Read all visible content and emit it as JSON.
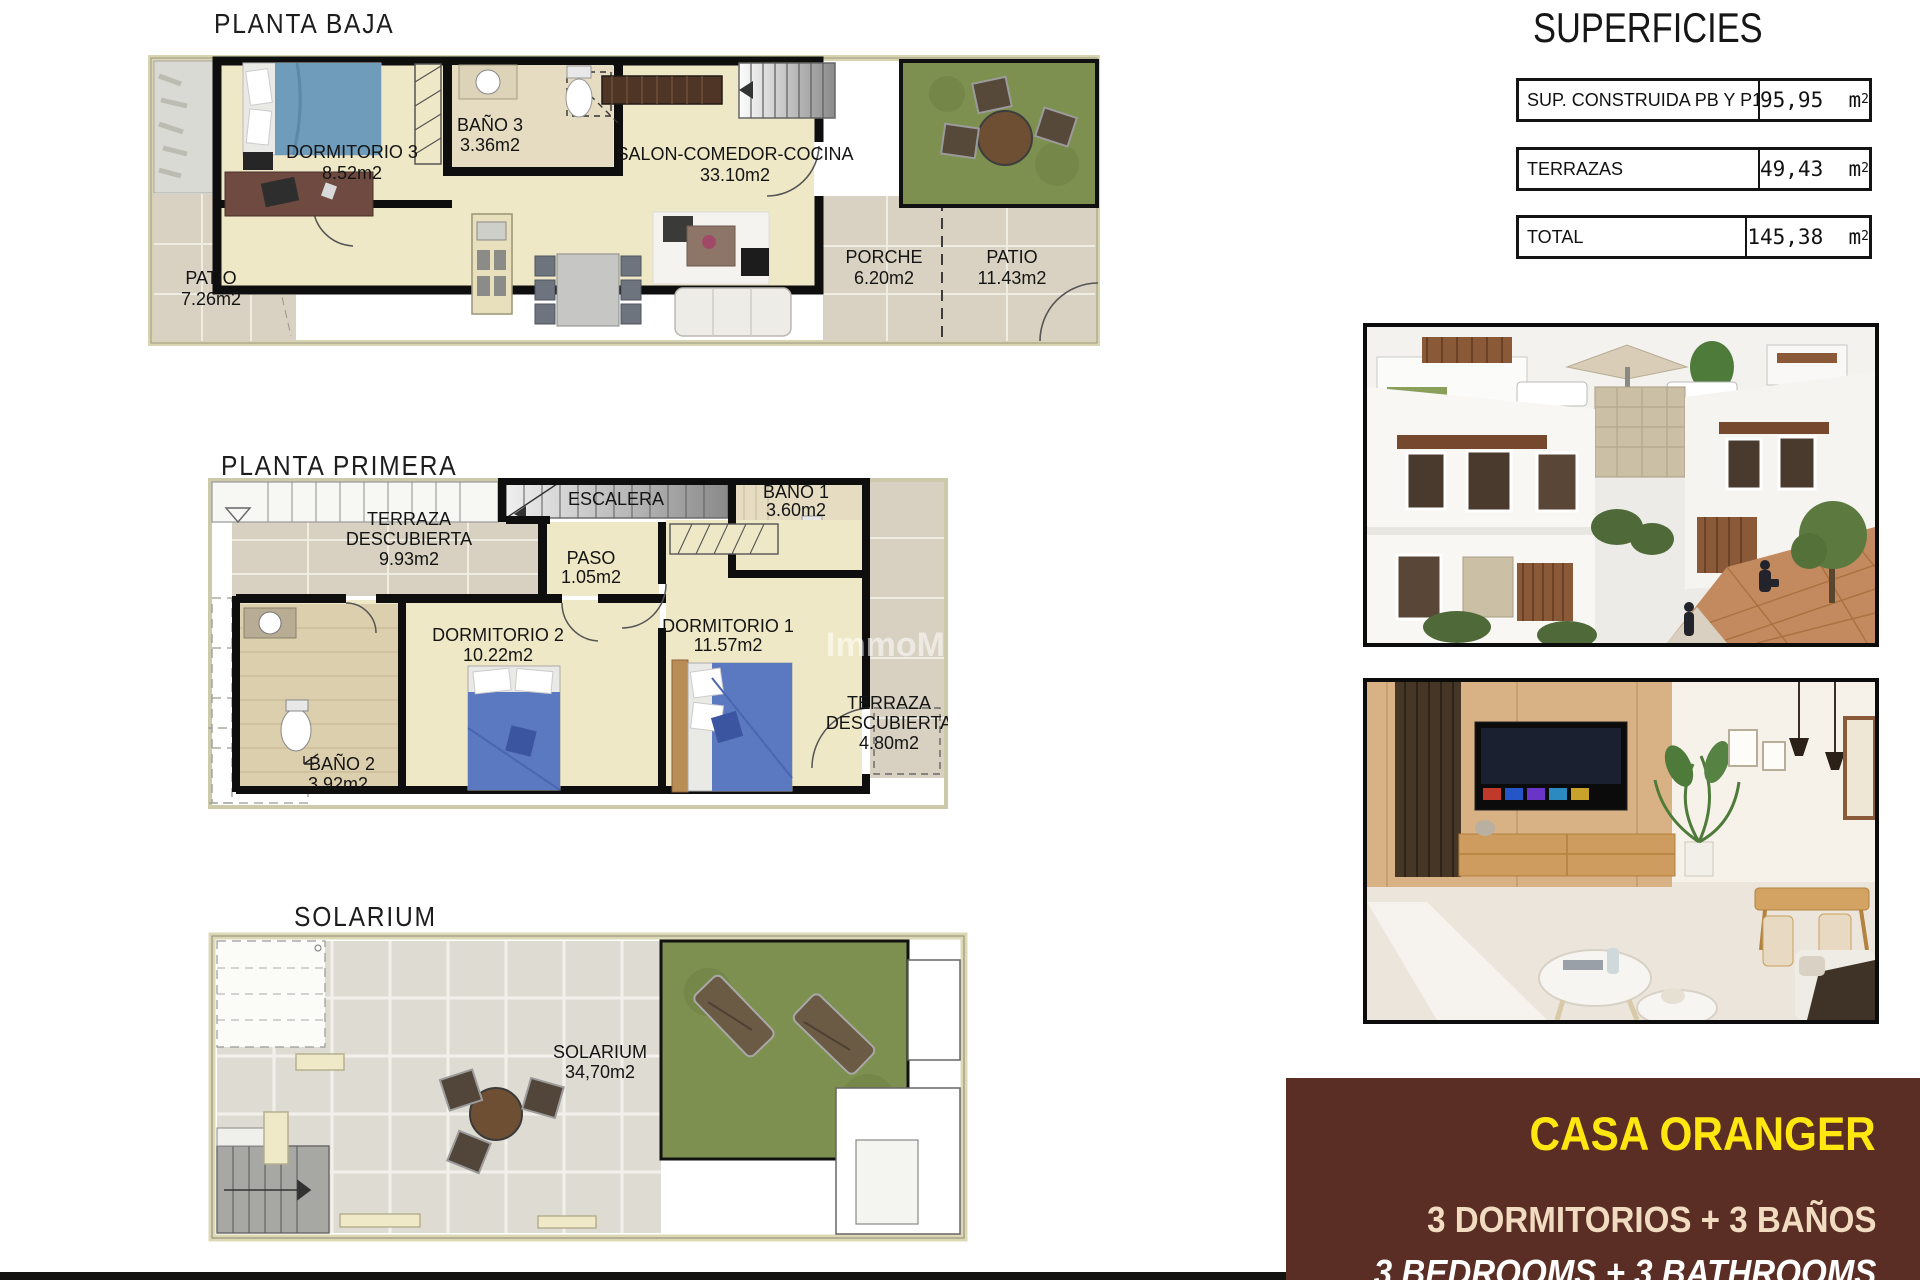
{
  "sections": {
    "planta_baja_title": "PLANTA BAJA",
    "planta_primera_title": "PLANTA PRIMERA",
    "solarium_title": "SOLARIUM"
  },
  "planta_baja": {
    "dormitorio3": {
      "name": "DORMITORIO 3",
      "area": "8.52m2"
    },
    "bano3": {
      "name": "BAÑO 3",
      "area": "3.36m2"
    },
    "salon": {
      "name": "SALON-COMEDOR-COCINA",
      "area": "33.10m2"
    },
    "porche": {
      "name": "PORCHE",
      "area": "6.20m2"
    },
    "patio_right": {
      "name": "PATIO",
      "area": "11.43m2"
    },
    "patio_left": {
      "name": "PATIO",
      "area": "7.26m2"
    }
  },
  "planta_primera": {
    "terraza_top": {
      "line1": "TERRAZA",
      "line2": "DESCUBIERTA",
      "area": "9.93m2"
    },
    "escalera": {
      "name": "ESCALERA"
    },
    "bano1": {
      "name": "BAÑO 1",
      "area": "3.60m2"
    },
    "paso": {
      "name": "PASO",
      "area": "1.05m2"
    },
    "dormitorio2": {
      "name": "DORMITORIO 2",
      "area": "10.22m2"
    },
    "dormitorio1": {
      "name": "DORMITORIO 1",
      "area": "11.57m2"
    },
    "bano2": {
      "name": "BAÑO 2",
      "area": "3.92m2"
    },
    "terraza_bottom": {
      "line1": "TERRAZA",
      "line2": "DESCUBIERTA",
      "area": "4.80m2"
    },
    "watermark": "ImmoM"
  },
  "solarium": {
    "room": {
      "name": "SOLARIUM",
      "area": "34,70m2"
    }
  },
  "superficies": {
    "title": "SUPERFICIES",
    "rows": [
      {
        "label": "SUP. CONSTRUIDA PB Y P1",
        "value": "95,95",
        "unit": "m",
        "sup": "2"
      },
      {
        "label": "TERRAZAS",
        "value": "49,43",
        "unit": "m",
        "sup": "2"
      },
      {
        "label": "TOTAL",
        "value": "145,38",
        "unit": "m",
        "sup": "2"
      }
    ]
  },
  "brand": {
    "name": "CASA ORANGER",
    "line_es": "3 DORMITORIOS + 3 BAÑOS",
    "line_en": "3 BEDROOMS + 3 BATHROOMS"
  },
  "colors": {
    "brand_bg": "#5b2e25",
    "brand_name": "#ffe70f",
    "brand_es": "#f1dbc1",
    "brand_en": "#ffffff",
    "floor_beige": "#efe8c6",
    "tile_gray": "#d9d2c3",
    "grass_green": "#7d9050",
    "wall_black": "#0e0e0e"
  }
}
